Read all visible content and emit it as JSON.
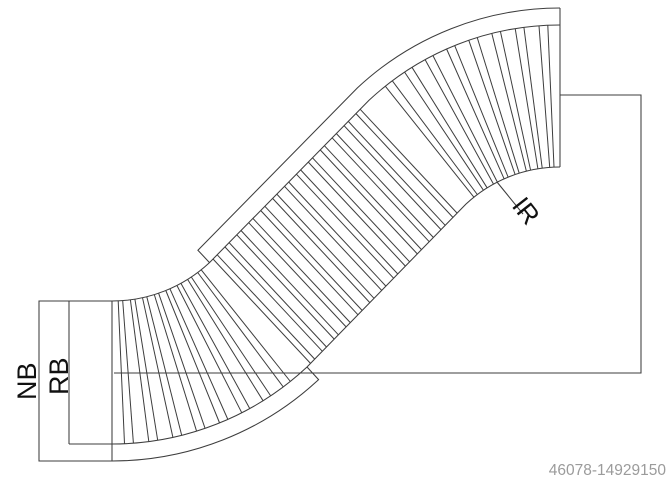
{
  "drawing": {
    "type": "technical-plan-view-curved-conveyor",
    "labels": {
      "nb": "NB",
      "rb": "RB",
      "ir": "IR"
    },
    "watermark_id": "46078-14929150",
    "colors": {
      "line": "#3d3d3d",
      "label_text": "#111111",
      "id_text": "#9b9b9b",
      "watermark": "#ebebeb",
      "background": "#ffffff"
    }
  }
}
